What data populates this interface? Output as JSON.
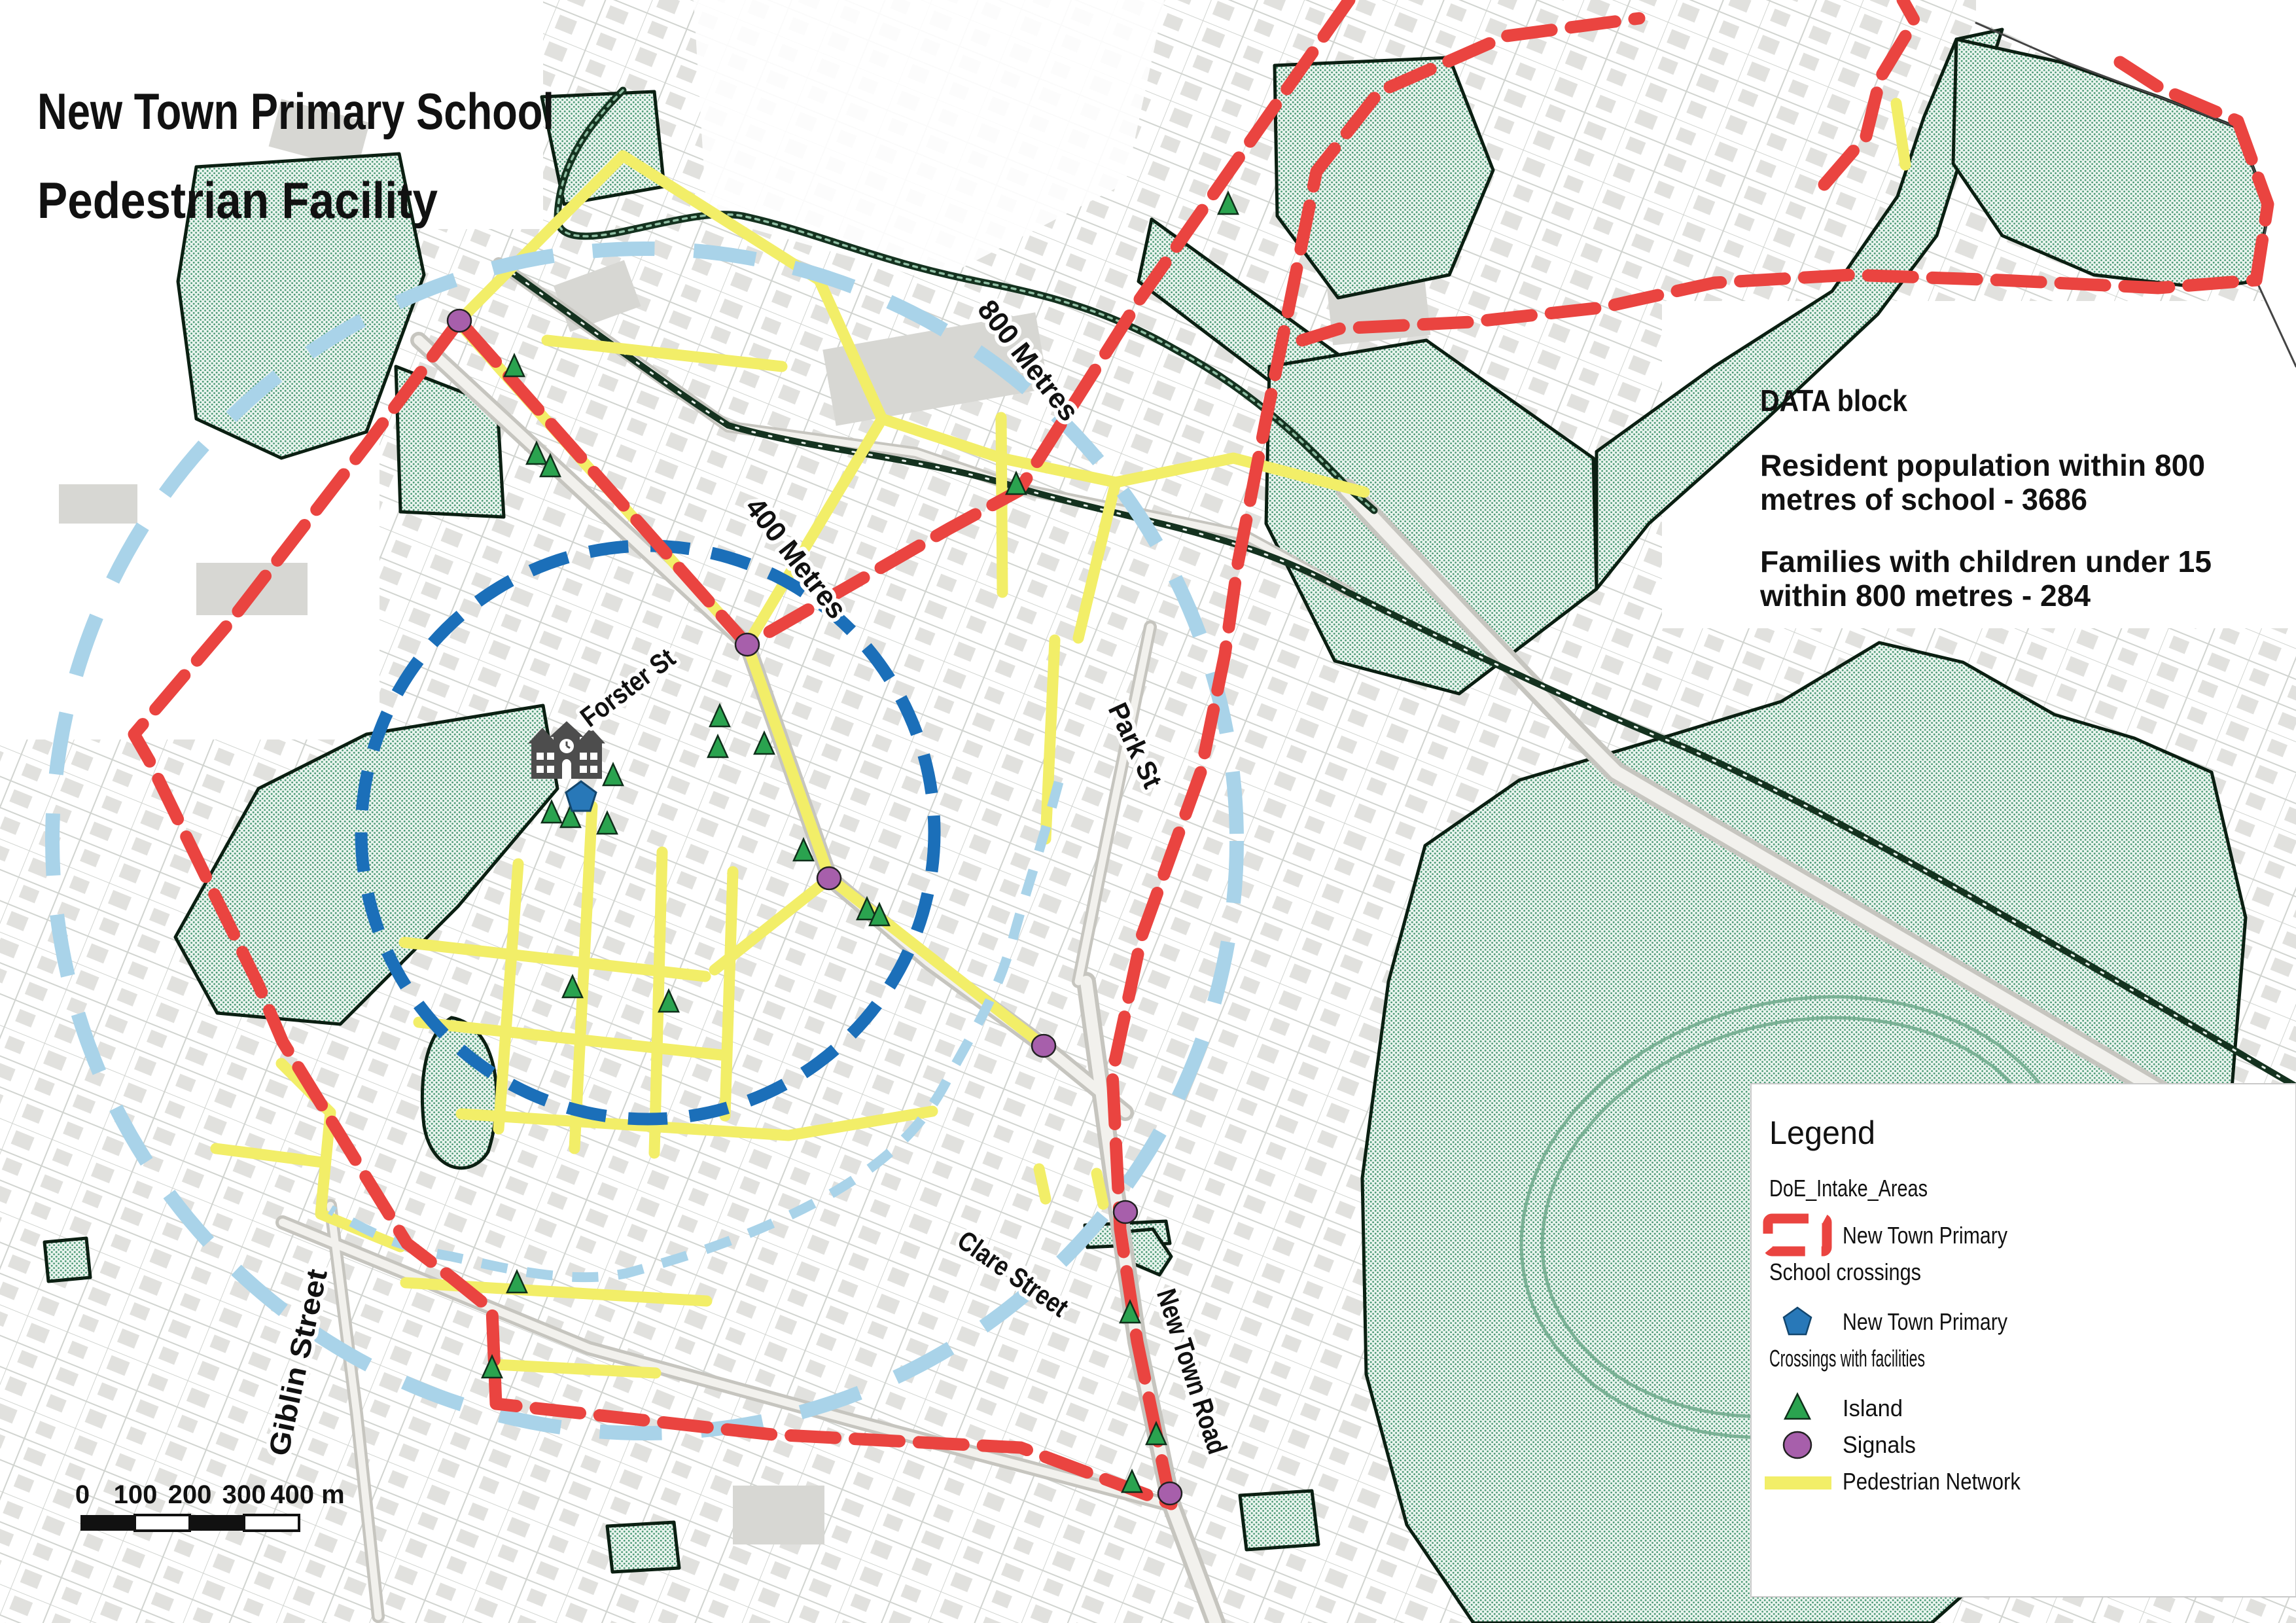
{
  "title": {
    "line1": "New Town Primary School",
    "line2": "Pedestrian Facility"
  },
  "data_block": {
    "heading": "DATA block",
    "para1_line1": "Resident population within 800",
    "para1_line2": "metres of school - 3686",
    "para2_line1": "Families with children under 15",
    "para2_line2": "within 800 metres - 284"
  },
  "legend": {
    "title": "Legend",
    "group_intake": "DoE_Intake_Areas",
    "intake_label": "New Town Primary",
    "group_school": "School crossings",
    "school_label": "New Town Primary",
    "group_crossings": "Crossings with facilities",
    "island_label": "Island",
    "signals_label": "Signals",
    "network_label": "Pedestrian Network"
  },
  "streets": {
    "forster": "Forster St",
    "park": "Park St",
    "giblin": "Giblin Street",
    "clare": "Clare Street",
    "newtown": "New Town Road"
  },
  "rings": {
    "r400_label": "400 Metres",
    "r800_label": "800 Metres"
  },
  "scalebar": {
    "labels": [
      "0",
      "100",
      "200",
      "300",
      "400 m"
    ]
  },
  "colors": {
    "intake_red": "#ea4440",
    "pedestrian_yellow": "#f2ee68",
    "ring800_blue": "#a9d3e9",
    "ring400_blue": "#1b6fb9",
    "island_green": "#2aa34f",
    "island_outline": "#0f2f1a",
    "signal_purple": "#a75fab",
    "school_pentagon_blue": "#2878b8",
    "park_dot_green": "#4d9b77",
    "creek_dark_green": "#14321f",
    "school_icon_gray": "#4d4d4d"
  },
  "map": {
    "islands": [
      [
        786,
        563
      ],
      [
        820,
        697
      ],
      [
        841,
        716
      ],
      [
        937,
        1188
      ],
      [
        1097,
        1145
      ],
      [
        1168,
        1140
      ],
      [
        1100,
        1098
      ],
      [
        843,
        1245
      ],
      [
        872,
        1252
      ],
      [
        928,
        1262
      ],
      [
        1228,
        1303
      ],
      [
        1325,
        1393
      ],
      [
        1344,
        1402
      ],
      [
        1553,
        743
      ],
      [
        1877,
        315
      ],
      [
        875,
        1512
      ],
      [
        1022,
        1534
      ],
      [
        790,
        1963
      ],
      [
        752,
        2093
      ],
      [
        1727,
        2009
      ],
      [
        1767,
        2195
      ],
      [
        1730,
        2268
      ]
    ],
    "signals": [
      [
        702,
        490
      ],
      [
        1142,
        985
      ],
      [
        1267,
        1342
      ],
      [
        1595,
        1598
      ],
      [
        1720,
        1852
      ],
      [
        1788,
        2282
      ]
    ],
    "school_pentagon": [
      888,
      1218
    ]
  }
}
